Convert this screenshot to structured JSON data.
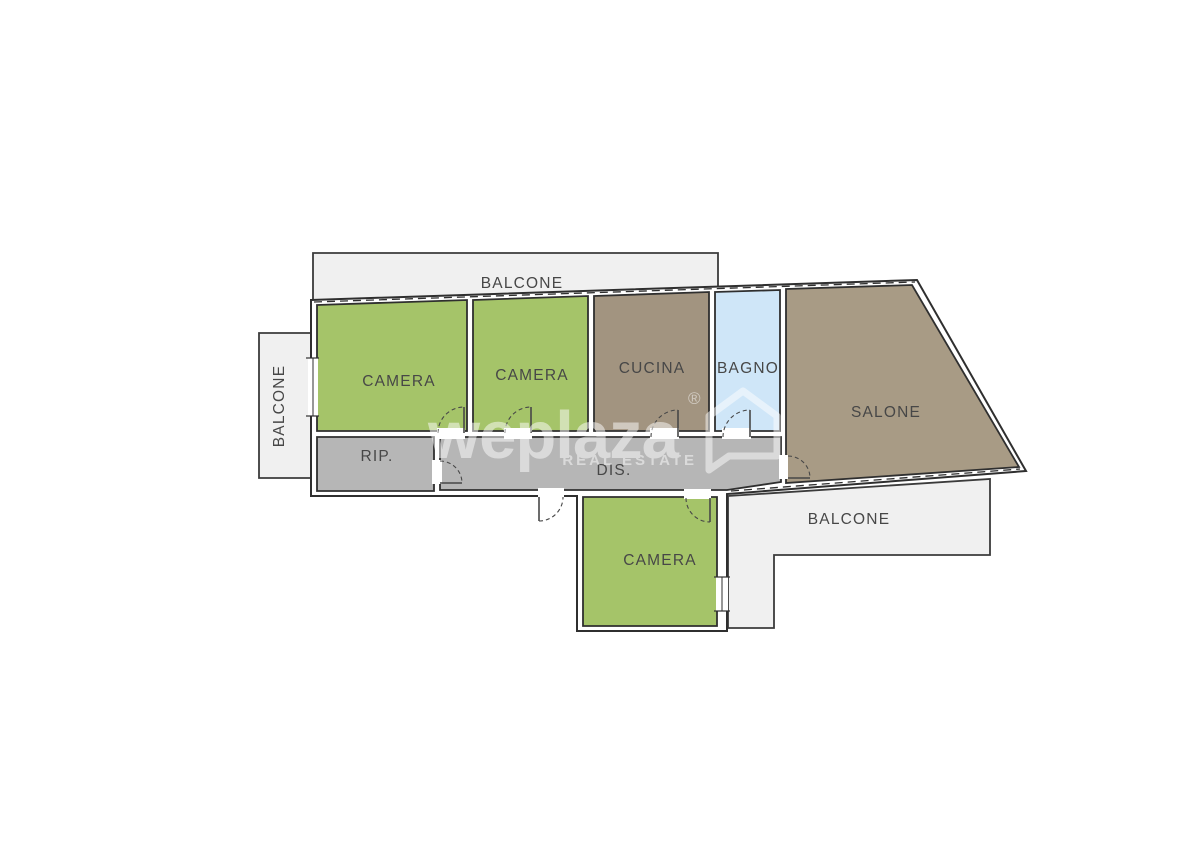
{
  "page": {
    "background": "#ffffff"
  },
  "floorplan": {
    "colors": {
      "bedroom": "#a5c469",
      "kitchen": "#a29480",
      "living": "#a89b85",
      "bath": "#cfe6f8",
      "hall": "#b6b6b6",
      "balcony": "#f0f0f0",
      "wall_line": "#2f2f2f",
      "label_text": "#474747"
    },
    "labels": {
      "balcone_top": "BALCONE",
      "balcone_left": "BALCONE",
      "balcone_bottom": "BALCONE",
      "camera_1": "CAMERA",
      "camera_2": "CAMERA",
      "camera_3": "CAMERA",
      "cucina": "CUCINA",
      "bagno": "BAGNO",
      "salone": "SALONE",
      "rip": "RIP.",
      "dis": "DIS."
    },
    "watermark": {
      "brand": "weplaza",
      "registered": "®",
      "tagline": "REAL ESTATE"
    }
  }
}
